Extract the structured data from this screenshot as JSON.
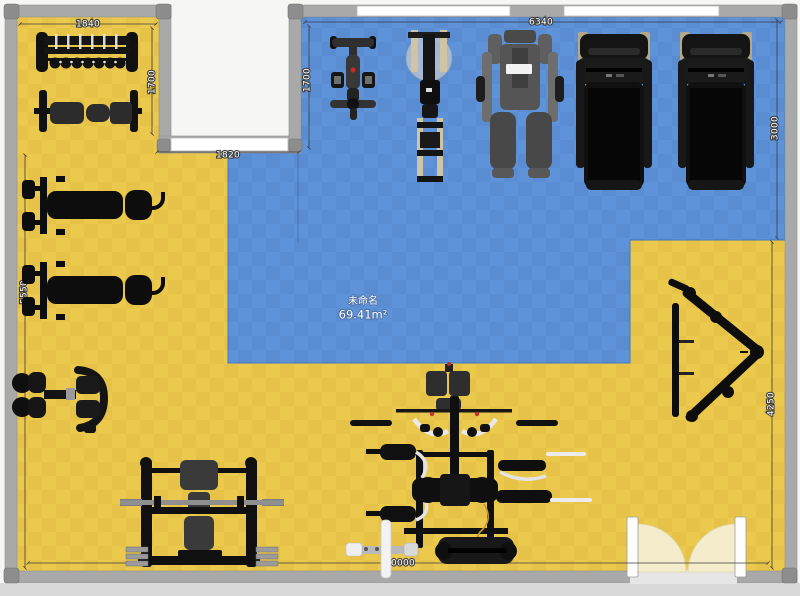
{
  "room": {
    "name": "未命名",
    "area": "69.41m²",
    "floor_color": "#ebc94d",
    "zone_color": "#5f93d9",
    "wall_color": "#a9a9a9",
    "door_arc_color": "#f4ecca"
  },
  "dimensions": {
    "alcove_width": "1840",
    "alcove_height": "1700",
    "zone_top_width": "6340",
    "zone_left_height": "1700",
    "notch_width": "1820",
    "right_upper_height": "3000",
    "right_lower_height": "4250",
    "left_height": "5550",
    "bottom_width": "10000"
  },
  "equipment": [
    "dumbbell-rack",
    "flat-bench",
    "bench-press-station-1",
    "bench-press-station-2",
    "preacher-curl-machine",
    "barbell-rack-with-bench",
    "spin-bike",
    "fan-bike",
    "multi-gym",
    "treadmill-1",
    "treadmill-2",
    "hack-squat-frame",
    "multi-station-trainer",
    "floor-barbell",
    "double-door"
  ]
}
